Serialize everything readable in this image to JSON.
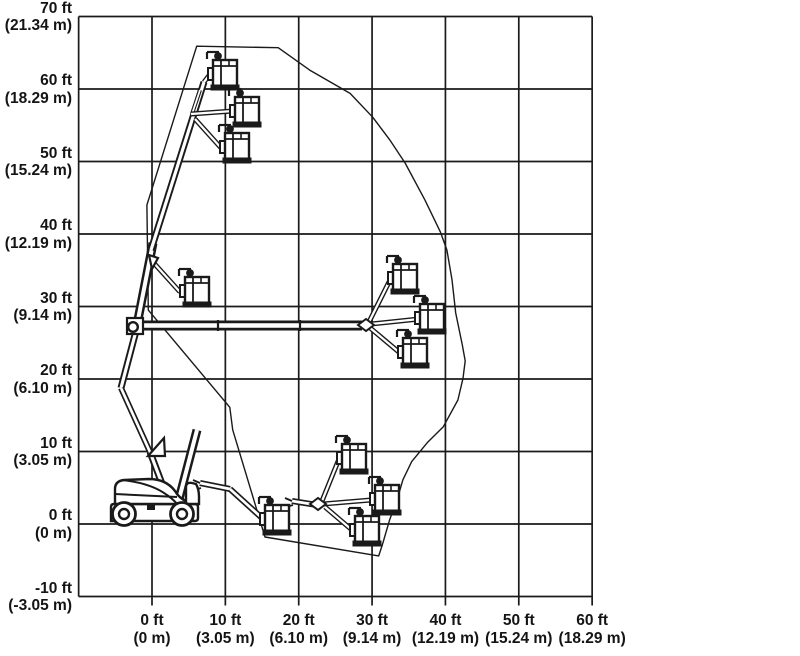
{
  "figure": {
    "width": 800,
    "height": 656,
    "background": "#ffffff",
    "line_color": "#1a1a1a",
    "grid_stroke": 1.7,
    "envelope_stroke": 1.4
  },
  "scale": {
    "origin_px": [
      152,
      524
    ],
    "px_per_ft_x": 7.3357,
    "px_per_ft_y": 7.25
  },
  "chart_data": {
    "type": "line",
    "title": "Articulating boom lift range of motion (working envelope) diagram",
    "xlabel": "Horizontal outreach ft (m)",
    "ylabel": "Platform height ft (m)",
    "xlim": [
      -10,
      60
    ],
    "ylim": [
      -10,
      70
    ],
    "grid": true,
    "grid_x_ft": [
      -10,
      0,
      10,
      20,
      30,
      40,
      50,
      60
    ],
    "grid_y_ft": [
      -10,
      0,
      10,
      20,
      30,
      40,
      50,
      60,
      70
    ],
    "x_ticks": [
      {
        "value": 0,
        "label_ft": "0 ft",
        "label_m": "(0 m)"
      },
      {
        "value": 10,
        "label_ft": "10 ft",
        "label_m": "(3.05 m)"
      },
      {
        "value": 20,
        "label_ft": "20 ft",
        "label_m": "(6.10 m)"
      },
      {
        "value": 30,
        "label_ft": "30 ft",
        "label_m": "(9.14 m)"
      },
      {
        "value": 40,
        "label_ft": "40 ft",
        "label_m": "(12.19 m)"
      },
      {
        "value": 50,
        "label_ft": "50 ft",
        "label_m": "(15.24 m)"
      },
      {
        "value": 60,
        "label_ft": "60 ft",
        "label_m": "(18.29 m)"
      }
    ],
    "y_ticks": [
      {
        "value": 70,
        "label_ft": "70 ft",
        "label_m": "(21.34 m)"
      },
      {
        "value": 60,
        "label_ft": "60 ft",
        "label_m": "(18.29 m)"
      },
      {
        "value": 50,
        "label_ft": "50 ft",
        "label_m": "(15.24 m)"
      },
      {
        "value": 40,
        "label_ft": "40 ft",
        "label_m": "(12.19 m)"
      },
      {
        "value": 30,
        "label_ft": "30 ft",
        "label_m": "(9.14 m)"
      },
      {
        "value": 20,
        "label_ft": "20 ft",
        "label_m": "(6.10 m)"
      },
      {
        "value": 10,
        "label_ft": "10 ft",
        "label_m": "(3.05 m)"
      },
      {
        "value": 0,
        "label_ft": "0 ft",
        "label_m": "(0 m)"
      },
      {
        "value": -10,
        "label_ft": "-10 ft",
        "label_m": "(-3.05 m)"
      }
    ],
    "series": [
      {
        "name": "working-envelope-outline",
        "closed": true,
        "points_ft": [
          [
            6.1,
            65.9
          ],
          [
            17.2,
            65.7
          ],
          [
            21.5,
            62.6
          ],
          [
            27.0,
            59.4
          ],
          [
            30.1,
            56.1
          ],
          [
            32.4,
            53.0
          ],
          [
            34.5,
            49.8
          ],
          [
            37.2,
            44.7
          ],
          [
            39.3,
            40.3
          ],
          [
            40.2,
            37.8
          ],
          [
            40.9,
            33.7
          ],
          [
            41.4,
            29.1
          ],
          [
            42.3,
            24.7
          ],
          [
            42.7,
            22.5
          ],
          [
            42.4,
            20.1
          ],
          [
            41.7,
            17.1
          ],
          [
            39.7,
            13.4
          ],
          [
            37.6,
            11.3
          ],
          [
            35.4,
            8.6
          ],
          [
            34.2,
            6.1
          ],
          [
            33.4,
            3.3
          ],
          [
            32.4,
            0.6
          ],
          [
            31.4,
            -2.9
          ],
          [
            30.9,
            -4.4
          ],
          [
            15.4,
            -1.8
          ],
          [
            11.0,
            13.0
          ],
          [
            10.6,
            16.1
          ],
          [
            -0.5,
            29.5
          ],
          [
            -0.7,
            44.0
          ]
        ]
      }
    ],
    "platform_positions_ft": [
      [
        9.9,
        62.2
      ],
      [
        12.9,
        57.0
      ],
      [
        11.6,
        52.1
      ],
      [
        6.1,
        32.2
      ],
      [
        34.4,
        34.0
      ],
      [
        38.4,
        28.4
      ],
      [
        35.8,
        23.8
      ],
      [
        17.0,
        0.7
      ],
      [
        27.5,
        9.1
      ],
      [
        32.1,
        3.4
      ],
      [
        29.3,
        -0.8
      ]
    ]
  },
  "machine_drawing": {
    "booms_px": [
      [
        136,
        331,
        121,
        388,
        7
      ],
      [
        121,
        388,
        150,
        452,
        6
      ],
      [
        150,
        452,
        167,
        497,
        7
      ],
      [
        178,
        503,
        197,
        430,
        9
      ],
      [
        136,
        330,
        153,
        243,
        9
      ],
      [
        151,
        250,
        204,
        82,
        7
      ],
      [
        200,
        90,
        192,
        114,
        4
      ],
      [
        191,
        114,
        233,
        111,
        5
      ],
      [
        195,
        119,
        222,
        149,
        5
      ],
      [
        204,
        82,
        211,
        73,
        5
      ],
      [
        152,
        261,
        180,
        292,
        5
      ],
      [
        140,
        325.5,
        362,
        325.5,
        10
      ],
      [
        369,
        322,
        390,
        280,
        5
      ],
      [
        371,
        324,
        419,
        319,
        5
      ],
      [
        369,
        327,
        400,
        353,
        5
      ],
      [
        200,
        483,
        230,
        489,
        6
      ],
      [
        230,
        489,
        262,
        518,
        6
      ],
      [
        292,
        501,
        317,
        505,
        6
      ],
      [
        322,
        501,
        339,
        459,
        5
      ],
      [
        323,
        504,
        371,
        500,
        5
      ],
      [
        325,
        507,
        352,
        530,
        5
      ]
    ],
    "joint_ticks_px": [
      [
        218,
        320,
        218,
        331
      ],
      [
        300,
        320,
        300,
        331
      ]
    ],
    "prongs_px": [
      [
        193,
        480,
        200,
        483
      ],
      [
        194,
        490,
        201,
        488
      ],
      [
        285,
        498,
        292,
        501
      ],
      [
        286,
        507,
        293,
        505
      ]
    ],
    "pivots_px": [
      [
        366,
        325
      ],
      [
        318,
        504
      ]
    ],
    "elbow_circle_px": [
      133,
      327,
      4.8
    ],
    "elbow_bracket_px": [
      127,
      318,
      16,
      16
    ],
    "triangles_px": [
      [
        [
          148,
          456
        ],
        [
          164,
          438
        ],
        [
          165,
          456
        ]
      ],
      [
        [
          149,
          255
        ],
        [
          158,
          258
        ],
        [
          152,
          269
        ]
      ]
    ],
    "baskets_px": [
      [
        209,
        74
      ],
      [
        231,
        111
      ],
      [
        221,
        147
      ],
      [
        181,
        291
      ],
      [
        389,
        278
      ],
      [
        416,
        318
      ],
      [
        399,
        352
      ],
      [
        261,
        519
      ],
      [
        338,
        458
      ],
      [
        371,
        499
      ],
      [
        351,
        530
      ]
    ],
    "chassis": {
      "frame_path": "M111,521 L111,507 Q111,504 114,504 L195,504 Q198,504 198,507 L198,518 Q198,521 195,521 Z",
      "cowl_path": "M115,504 L115,489 Q115,481 124,480 L149,479 Q166,479 175,491 Q179,498 186,501 L186,504 Z",
      "cowl_inner_path": "M122,480 Q151,483 167,495 Q174,500 177,504",
      "belt_line_path": "M115,494 L177,497",
      "turret_path": "M186,504 L186,487 Q186,482 192,483 L196,484 Q199,489 199,497 L199,504 Z",
      "axle_rect": [
        147,
        504,
        8,
        6
      ],
      "wheels_px": [
        [
          124,
          514,
          11.5,
          5
        ],
        [
          182,
          514,
          11.5,
          5
        ]
      ]
    }
  }
}
